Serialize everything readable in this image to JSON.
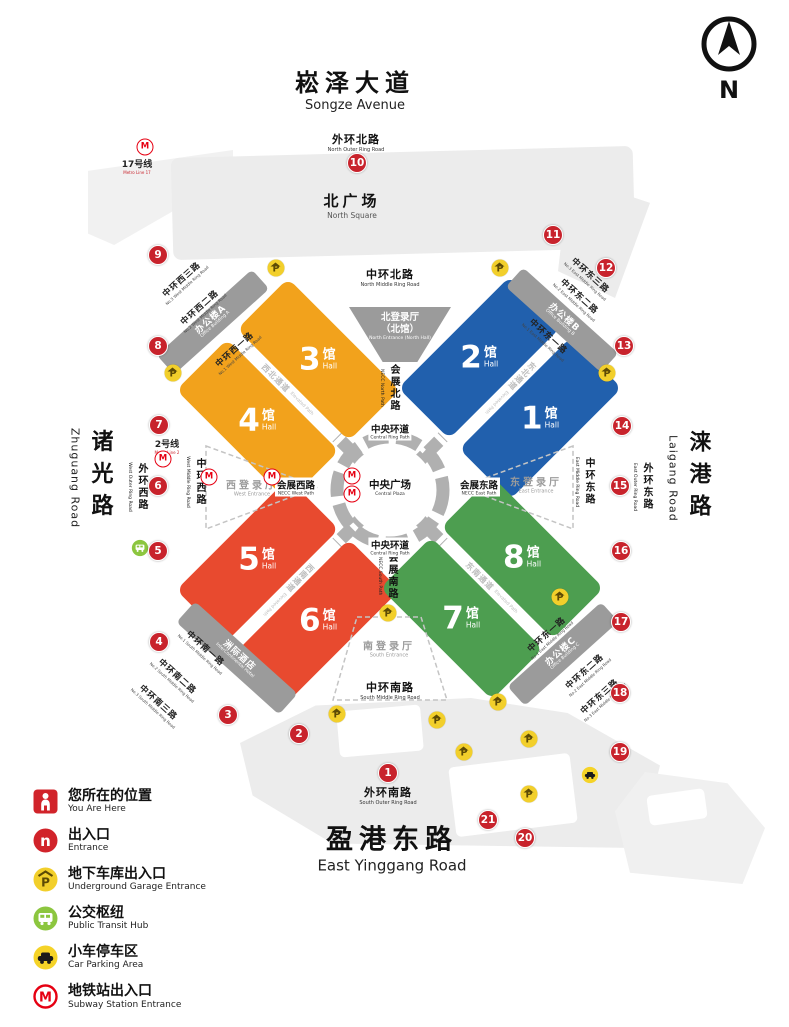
{
  "compass": {
    "letter": "N"
  },
  "roads": {
    "songze": {
      "cn": "崧泽大道",
      "en": "Songze Avenue"
    },
    "outer_north": {
      "cn": "外环北路",
      "en": "North Outer Ring Road"
    },
    "middle_north": {
      "cn": "中环北路",
      "en": "North Middle Ring Road"
    },
    "middle_south": {
      "cn": "中环南路",
      "en": "South Middle Ring Road"
    },
    "outer_south": {
      "cn": "外环南路",
      "en": "South Outer Ring Road"
    },
    "yinggang": {
      "cn": "盈港东路",
      "en": "East Yinggang Road"
    },
    "zhuguang": {
      "cn": "诸光路",
      "en": "Zhuguang Road"
    },
    "laigang": {
      "cn": "涞港路",
      "en": "Laigang Road"
    },
    "outer_west": {
      "cn": "外环西路",
      "en": "West Outer Ring Road"
    },
    "middle_west": {
      "cn": "中环西路",
      "en": "West Middle Ring Road"
    },
    "middle_east": {
      "cn": "中环东路",
      "en": "East Middle Ring Road"
    },
    "outer_east": {
      "cn": "外环东路",
      "en": "East Outer Ring Road"
    },
    "west1": {
      "cn": "中环西一路",
      "en": "No.1 West Middle Ring Road"
    },
    "west2": {
      "cn": "中环西二路",
      "en": "No.2 West Middle Ring Road"
    },
    "west3": {
      "cn": "中环西三路",
      "en": "No.3 West Middle Ring Road"
    },
    "east1": {
      "cn": "中环东一路",
      "en": "No.1 East Middle Ring Road"
    },
    "east2": {
      "cn": "中环东二路",
      "en": "No.2 East Middle Ring Road"
    },
    "east3": {
      "cn": "中环东三路",
      "en": "No.3 East Middle Ring Road"
    },
    "south1": {
      "cn": "中环南一路",
      "en": "No.1 South Middle Ring Road"
    },
    "south2": {
      "cn": "中环南二路",
      "en": "No.2 South Middle Ring Road"
    },
    "south3": {
      "cn": "中环南三路",
      "en": "No.3 South Middle Ring Road"
    }
  },
  "areas": {
    "north_square": {
      "cn": "北广场",
      "en": "North Square"
    },
    "central_plaza": {
      "cn": "中央广场",
      "en": "Central Plaza"
    },
    "central_ring": {
      "cn": "中央环道",
      "en": "Central Ring Path"
    },
    "office_a": {
      "cn": "办公楼A",
      "en": "Office Building A"
    },
    "office_b": {
      "cn": "办公楼B",
      "en": "Office Building B"
    },
    "office_c": {
      "cn": "办公楼C",
      "en": "Office Building C"
    },
    "hotel": {
      "cn": "洲际酒店",
      "en": "InterContinental Hotel"
    }
  },
  "entrances": {
    "north": {
      "cn1": "北登录厅",
      "cn2": "（北馆）",
      "en": "North Entrance (North Hall)"
    },
    "west": {
      "cn": "西登录厅",
      "en": "West Entrance"
    },
    "east": {
      "cn": "东登录厅",
      "en": "East Entrance"
    },
    "south": {
      "cn": "南登录厅",
      "en": "South Entrance"
    }
  },
  "paths": {
    "necc_north": {
      "cn": "会展北路",
      "en": "NECC North Path"
    },
    "necc_west": {
      "cn": "会展西路",
      "en": "NECC West Path"
    },
    "necc_east": {
      "cn": "会展东路",
      "en": "NECC East Path"
    },
    "necc_south": {
      "cn": "会展南路",
      "en": "NECC South Path"
    },
    "nw": {
      "cn": "西北通道",
      "en": "Elevated Path"
    },
    "ne": {
      "cn": "东北通道",
      "en": "Elevated Path"
    },
    "sw": {
      "cn": "西南通道",
      "en": "Elevated Path"
    },
    "se": {
      "cn": "东南通道",
      "en": "Elevated Path"
    }
  },
  "halls": [
    {
      "num": "1",
      "unit": "馆",
      "en": "Hall"
    },
    {
      "num": "2",
      "unit": "馆",
      "en": "Hall"
    },
    {
      "num": "3",
      "unit": "馆",
      "en": "Hall"
    },
    {
      "num": "4",
      "unit": "馆",
      "en": "Hall"
    },
    {
      "num": "5",
      "unit": "馆",
      "en": "Hall"
    },
    {
      "num": "6",
      "unit": "馆",
      "en": "Hall"
    },
    {
      "num": "7",
      "unit": "馆",
      "en": "Hall"
    },
    {
      "num": "8",
      "unit": "馆",
      "en": "Hall"
    }
  ],
  "metro": {
    "line17": {
      "cn": "17号线",
      "en": "Metro Line 17"
    },
    "line2": {
      "cn": "2号线",
      "en": "Metro Line 2"
    }
  },
  "legend": {
    "items": [
      {
        "cn": "您所在的位置",
        "en": "You Are Here"
      },
      {
        "cn": "出入口",
        "en": "Entrance"
      },
      {
        "cn": "地下车库出入口",
        "en": "Underground Garage Entrance"
      },
      {
        "cn": "公交枢纽",
        "en": "Public Transit Hub"
      },
      {
        "cn": "小车停车区",
        "en": "Car Parking Area"
      },
      {
        "cn": "地铁站出入口",
        "en": "Subway Station Entrance"
      }
    ]
  },
  "icons": {
    "parking_glyph": "P",
    "metro_glyph": "M",
    "entrance_glyph": "n"
  },
  "colors": {
    "hall_orange": "#F2A21C",
    "hall_blue": "#2160AD",
    "hall_red": "#E84A2F",
    "hall_green": "#4D9E50",
    "marker_red": "#C8232C",
    "garage_yellow": "#F2CF2B",
    "transit_green": "#8CC63F",
    "metro_red": "#E60012",
    "building_gray": "#9B9B9B",
    "square_gray": "#ECECEC"
  },
  "markers": [
    {
      "n": "1",
      "x": 388,
      "y": 773
    },
    {
      "n": "2",
      "x": 299,
      "y": 734
    },
    {
      "n": "3",
      "x": 228,
      "y": 715
    },
    {
      "n": "4",
      "x": 159,
      "y": 642
    },
    {
      "n": "5",
      "x": 158,
      "y": 551
    },
    {
      "n": "6",
      "x": 158,
      "y": 486
    },
    {
      "n": "7",
      "x": 159,
      "y": 425
    },
    {
      "n": "8",
      "x": 158,
      "y": 346
    },
    {
      "n": "9",
      "x": 158,
      "y": 255
    },
    {
      "n": "10",
      "x": 357,
      "y": 163
    },
    {
      "n": "11",
      "x": 553,
      "y": 235
    },
    {
      "n": "12",
      "x": 606,
      "y": 268
    },
    {
      "n": "13",
      "x": 624,
      "y": 346
    },
    {
      "n": "14",
      "x": 622,
      "y": 426
    },
    {
      "n": "15",
      "x": 620,
      "y": 486
    },
    {
      "n": "16",
      "x": 621,
      "y": 551
    },
    {
      "n": "17",
      "x": 621,
      "y": 622
    },
    {
      "n": "18",
      "x": 620,
      "y": 693
    },
    {
      "n": "19",
      "x": 620,
      "y": 752
    },
    {
      "n": "20",
      "x": 525,
      "y": 838
    },
    {
      "n": "21",
      "x": 488,
      "y": 820
    }
  ],
  "garage_icons": [
    {
      "x": 276,
      "y": 268
    },
    {
      "x": 500,
      "y": 268
    },
    {
      "x": 173,
      "y": 373
    },
    {
      "x": 607,
      "y": 373
    },
    {
      "x": 560,
      "y": 597
    },
    {
      "x": 388,
      "y": 613
    },
    {
      "x": 498,
      "y": 702
    },
    {
      "x": 337,
      "y": 714
    },
    {
      "x": 437,
      "y": 720
    },
    {
      "x": 464,
      "y": 752
    },
    {
      "x": 529,
      "y": 739
    },
    {
      "x": 529,
      "y": 794
    }
  ],
  "metro_icons": [
    {
      "x": 145,
      "y": 147
    },
    {
      "x": 163,
      "y": 459
    },
    {
      "x": 209,
      "y": 477
    },
    {
      "x": 272,
      "y": 477
    },
    {
      "x": 352,
      "y": 476
    },
    {
      "x": 352,
      "y": 494
    }
  ]
}
